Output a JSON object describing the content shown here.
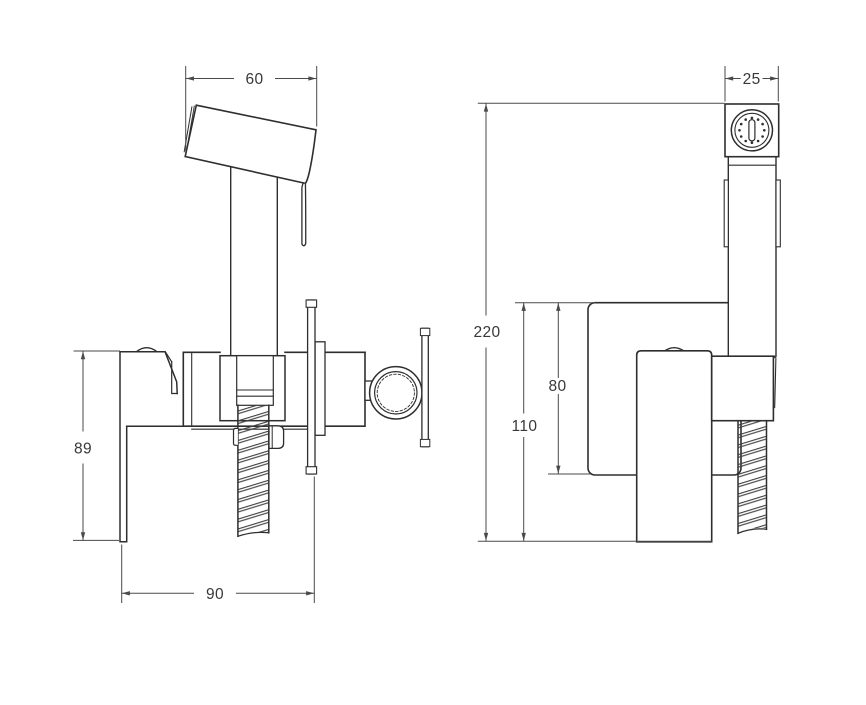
{
  "drawing": {
    "kind": "technical-drawing-bidet-hand-shower-mixer",
    "background": "#ffffff",
    "colors": {
      "outline": "#2e2e2e",
      "dimension_line": "#4a4a4a",
      "text": "#383838"
    },
    "dimensions": {
      "front_view": {
        "spray_head_width": "60",
        "lever_drop": "89",
        "body_width": "90"
      },
      "side_view": {
        "head_depth": "25",
        "total_height": "220",
        "plate_to_lever_bottom": "110",
        "wall_plate_height": "80"
      }
    }
  }
}
